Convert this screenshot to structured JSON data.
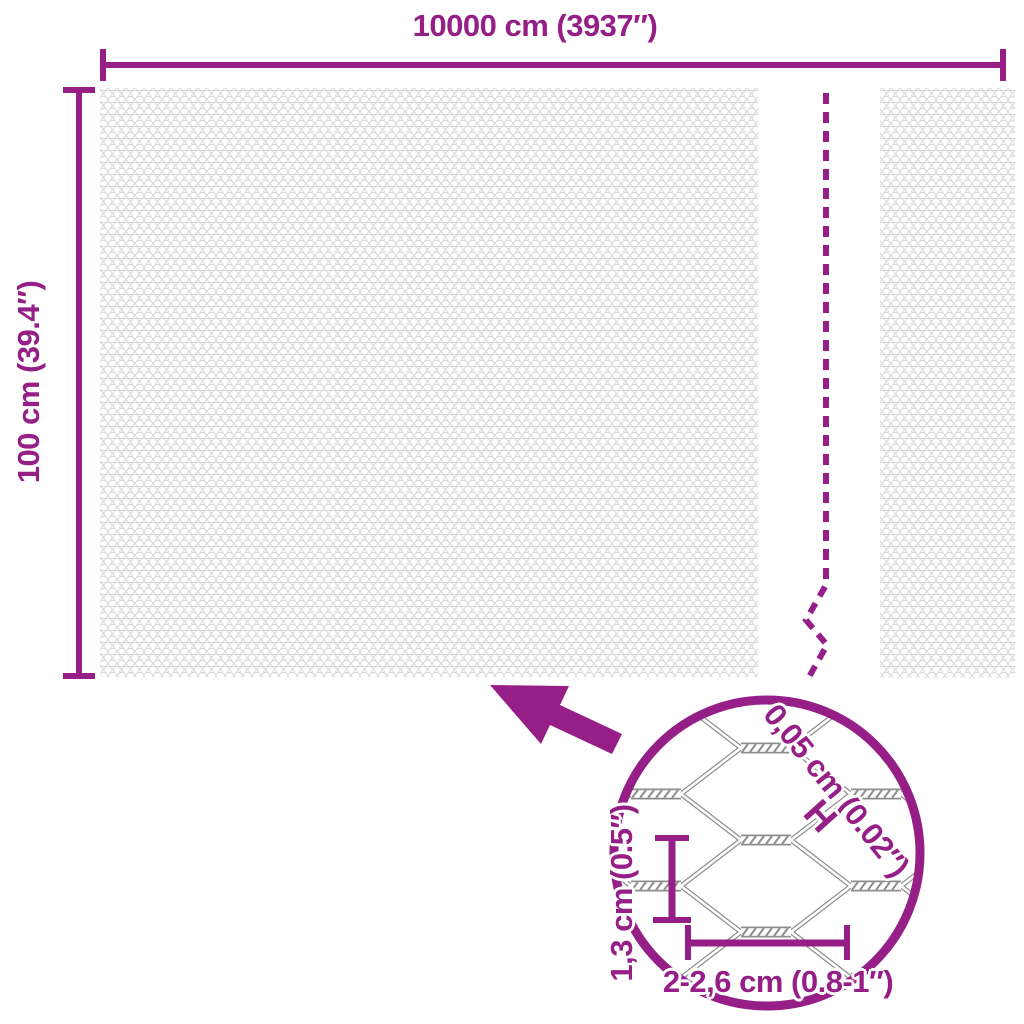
{
  "title": "hexagonal wire mesh roll dimensions diagram",
  "colors": {
    "accent": "#961E87",
    "wire_gray": "#8F8F8F",
    "mesh_texture_gray": "#D8D8D8"
  },
  "dimensions": {
    "roll_width": "10000 cm (3937″)",
    "roll_height": "100 cm (39.4″)"
  },
  "detail_view": {
    "wire_thickness": "0,05 cm (0.02″)",
    "thickness_marker": "H",
    "mesh_height": "1,3 cm (0.5″)",
    "mesh_width": "2-2,6 cm (0.8-1″)"
  }
}
